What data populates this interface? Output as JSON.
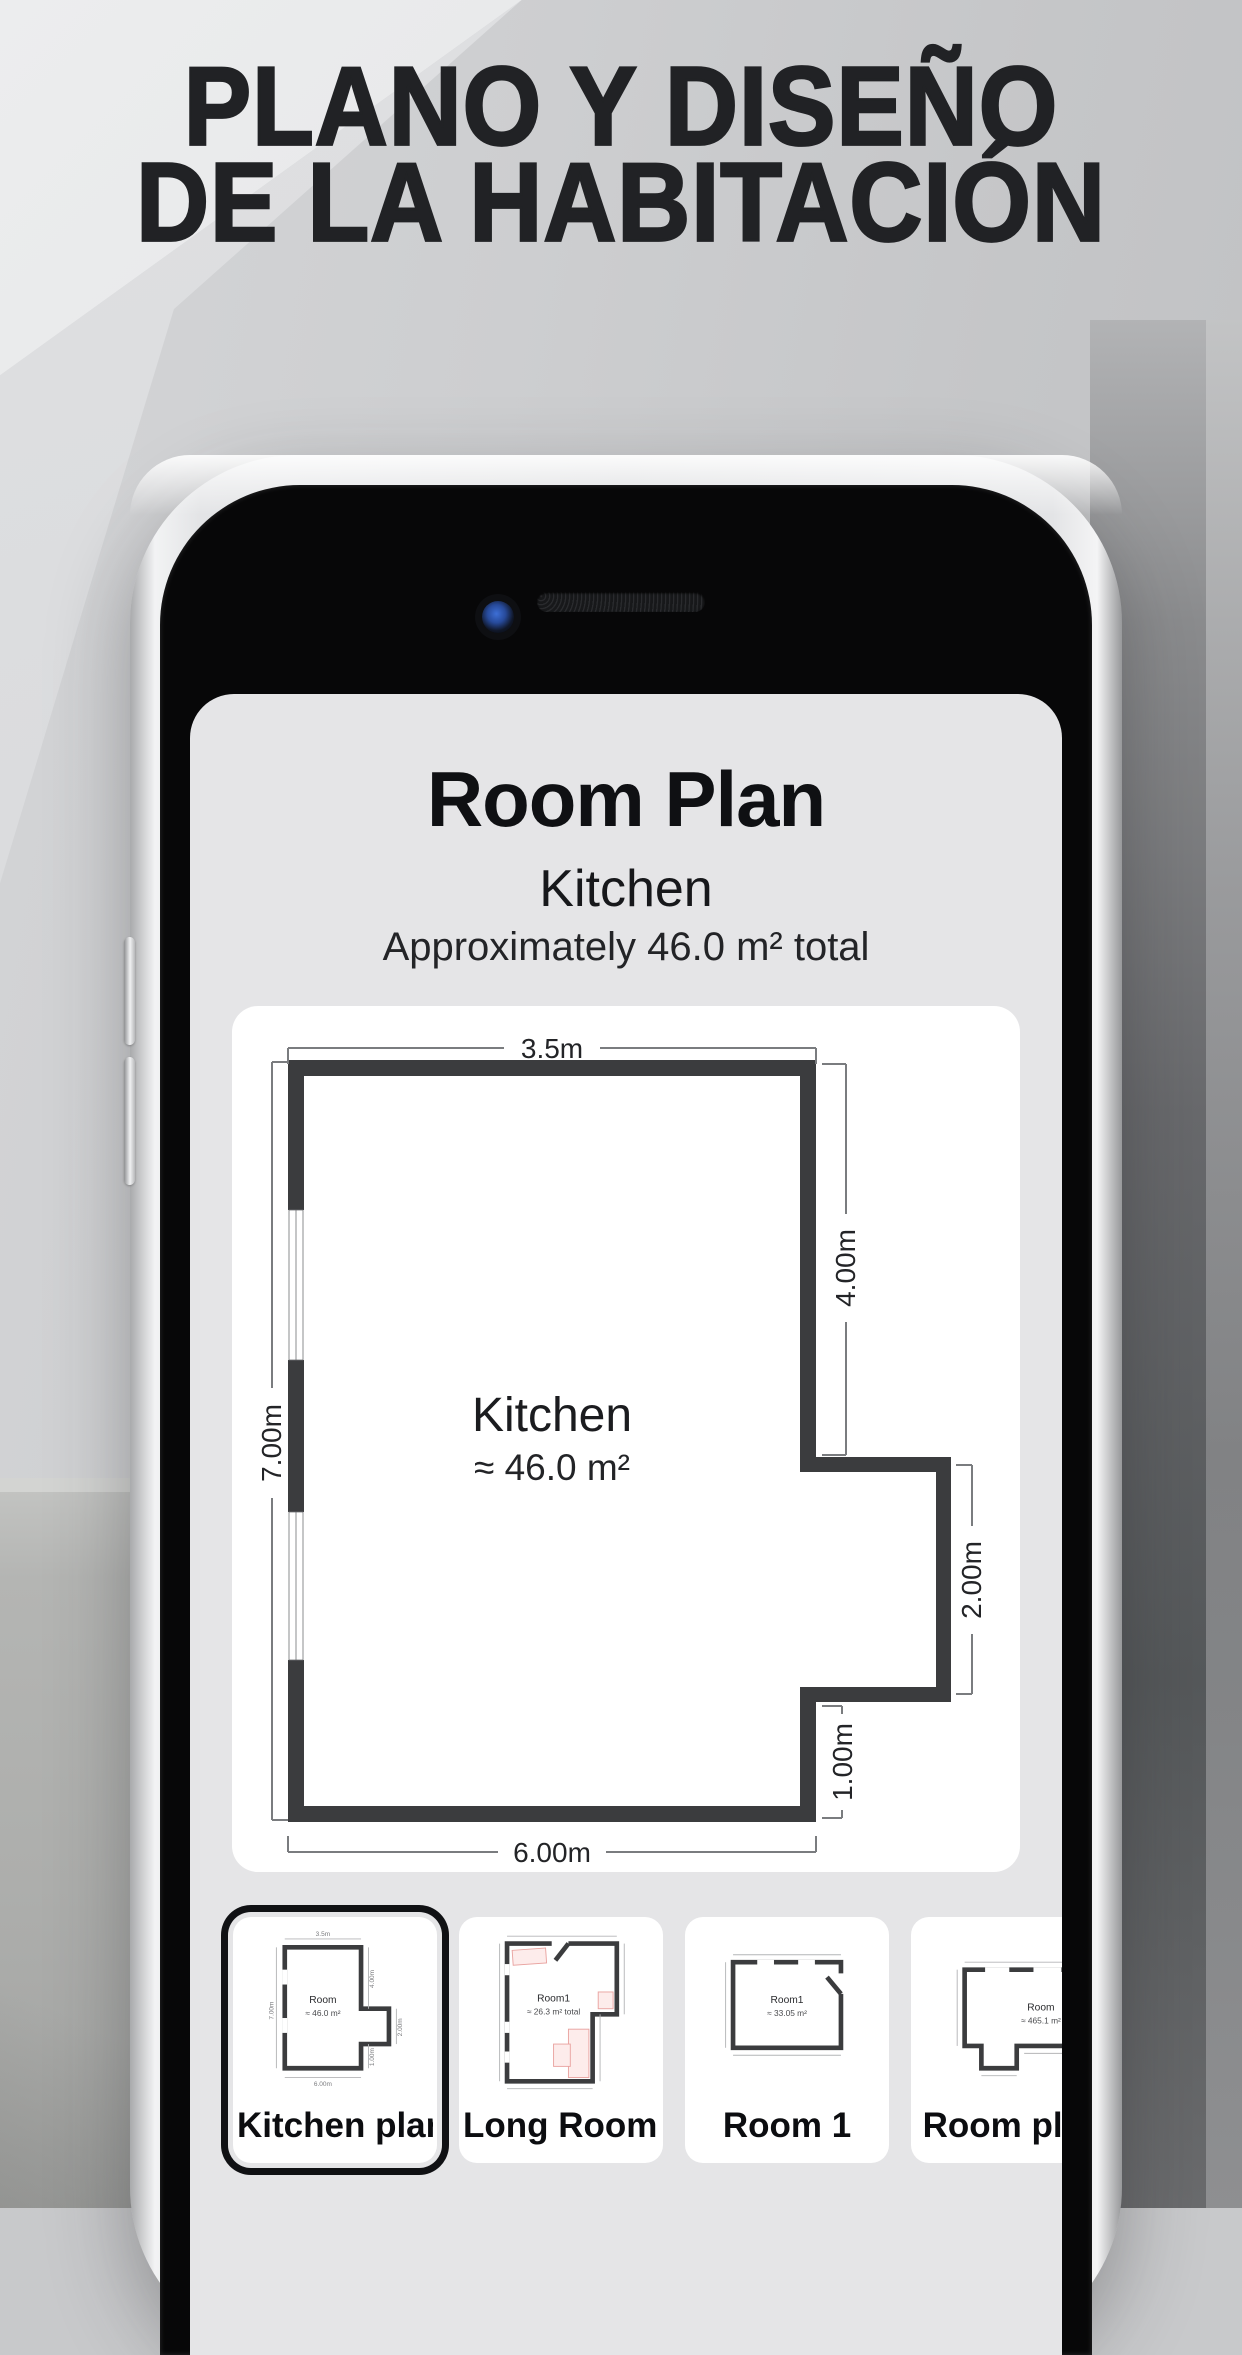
{
  "headline": {
    "line1": "PLANO Y DISEÑO",
    "line2": "DE LA HABITACIÓN"
  },
  "app": {
    "header": {
      "title": "Room Plan",
      "room_name": "Kitchen",
      "area_summary": "Approximately 46.0 m² total"
    },
    "plan": {
      "room_label": "Kitchen",
      "room_area": "≈ 46.0 m²",
      "dims": {
        "top": "3.5m",
        "left": "7.00m",
        "right_upper": "4.00m",
        "right_bump": "2.00m",
        "right_lower": "1.00m",
        "bottom": "6.00m"
      }
    },
    "thumbnails": [
      {
        "label": "Kitchen plan",
        "selected": true,
        "mini": {
          "room_label": "Room",
          "room_area": "≈ 46.0 m²",
          "dims": {
            "top": "3.5m",
            "left": "7.00m",
            "right_upper": "4.00m",
            "right_bump": "2.00m",
            "right_lower": "1.00m",
            "bottom": "6.00m"
          }
        }
      },
      {
        "label": "Long Room…",
        "selected": false,
        "mini": {
          "room_label": "Room1",
          "room_area": "≈ 26.3 m² total"
        }
      },
      {
        "label": "Room 1",
        "selected": false,
        "mini": {
          "room_label": "Room1",
          "room_area": "≈ 33.05 m²"
        }
      },
      {
        "label": "Room plan",
        "selected": false,
        "mini": {
          "room_label": "Room",
          "room_area": "≈ 465.1 m²"
        }
      }
    ]
  },
  "colors": {
    "panel_gray": "#e5e5e7",
    "card_white": "#ffffff",
    "wall": "#3b3c3e",
    "selected_ring": "#101114",
    "furniture_pink": "#fdeceb",
    "headline_text": "#212225"
  }
}
